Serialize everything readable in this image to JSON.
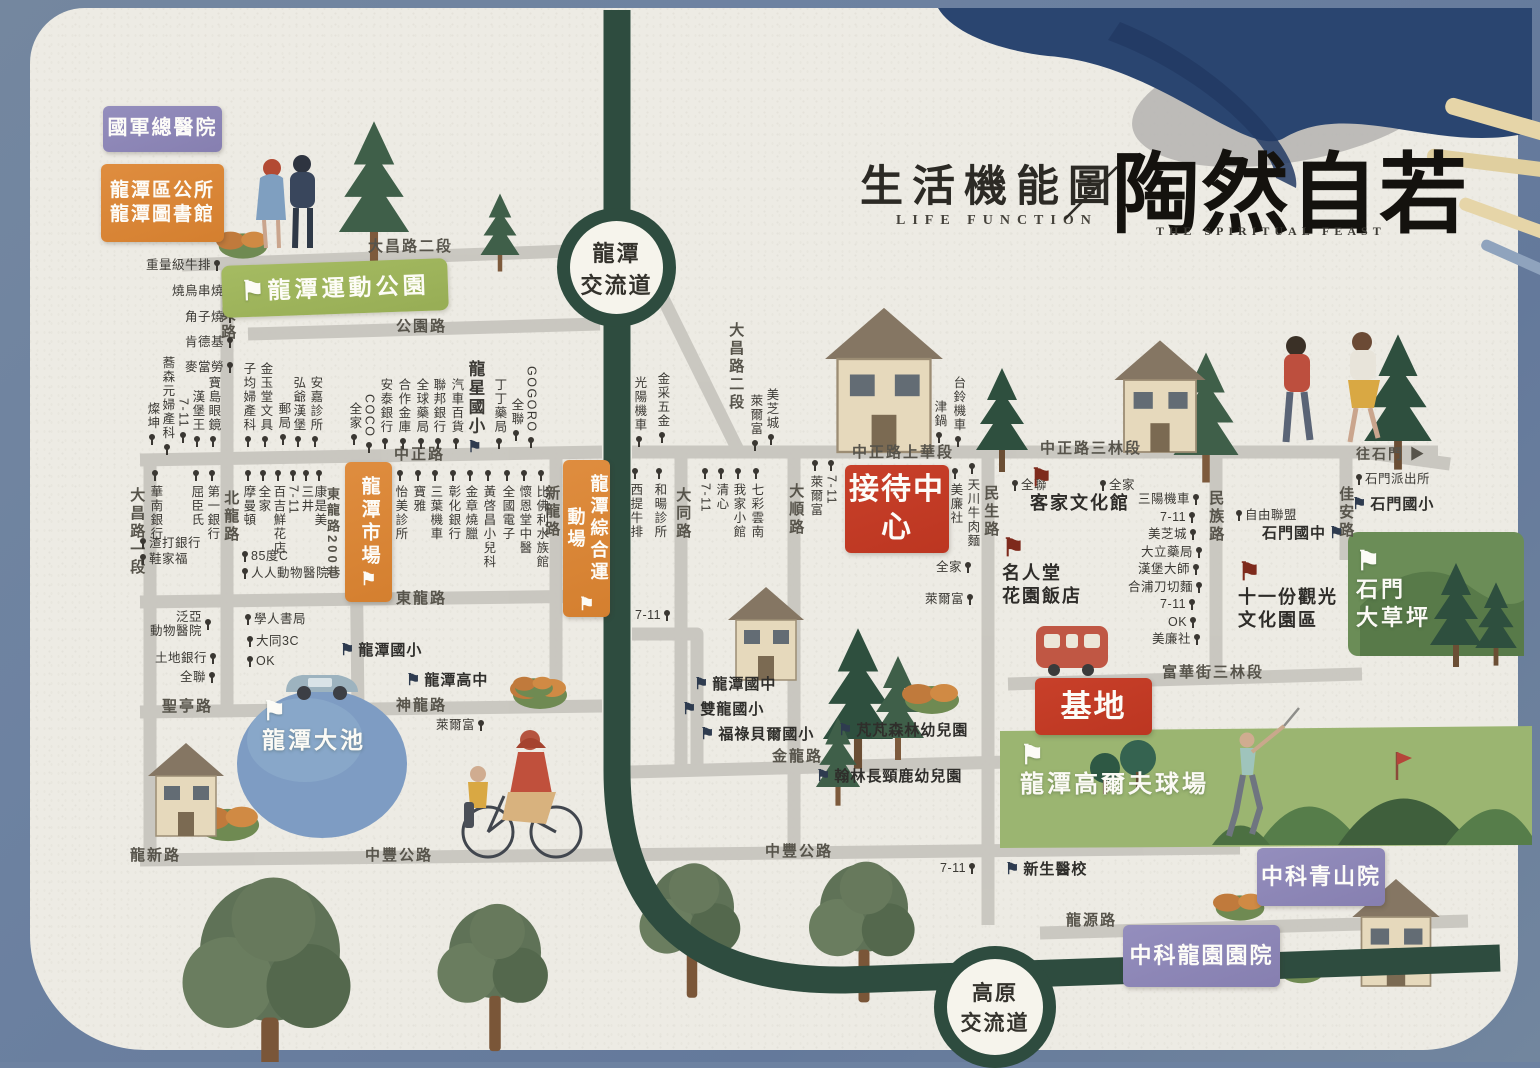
{
  "title": {
    "zh": "生活機能圖",
    "en": "LIFE FUNCTION",
    "slash": "／",
    "brand": "陶然自若",
    "brand_en": "THE SPIRITUAL FEAST"
  },
  "interchanges": [
    {
      "lines": [
        "龍潭",
        "交流道"
      ]
    },
    {
      "lines": [
        "高原",
        "交流道"
      ]
    }
  ],
  "palette": {
    "paper": "#edebe4",
    "border_blue": "#6d82a1",
    "freeway_green": "#2e4c3f",
    "road_gray": "#c7c4be",
    "box_red": "#c23c26",
    "box_orange": "#d9863a",
    "box_purple": "#8d87b7",
    "park_green": "#9fb65f",
    "pond_blue": "#7e9cc3",
    "golf_green": "#9bb571",
    "grass_green": "#6b8d57"
  },
  "map": {
    "items": [
      {
        "t": "大昌路二段",
        "c": "rh",
        "x": 368,
        "y": 238,
        "n": "road-label-dachang-rd-sec2"
      },
      {
        "t": "公園路",
        "c": "rh",
        "x": 396,
        "y": 318,
        "n": "road-label-gongyuan-rd"
      },
      {
        "t": "中興路",
        "c": "rv",
        "x": 219,
        "y": 288,
        "n": "road-label-zhongxing-rd"
      },
      {
        "t": "中正路",
        "c": "rh",
        "x": 394,
        "y": 446,
        "n": "road-label-zhongzheng-rd"
      },
      {
        "t": "北龍路",
        "c": "rv",
        "x": 222,
        "y": 490,
        "n": "road-label-beilong-rd"
      },
      {
        "t": "大昌路一段",
        "c": "rv",
        "x": 128,
        "y": 487,
        "n": "road-label-dachang-rd-sec1"
      },
      {
        "t": "東龍路",
        "c": "rh",
        "x": 396,
        "y": 590,
        "n": "road-label-donglong-rd"
      },
      {
        "t": "東龍路200巷",
        "c": "rv",
        "x": 324,
        "y": 487,
        "fs": 13,
        "n": "road-label-donglong-ln200"
      },
      {
        "t": "聖亭路",
        "c": "rh",
        "x": 162,
        "y": 698,
        "n": "road-label-shengting-rd"
      },
      {
        "t": "神龍路",
        "c": "rh",
        "x": 396,
        "y": 697,
        "n": "road-label-shenlong-rd"
      },
      {
        "t": "龍新路",
        "c": "rh",
        "x": 130,
        "y": 847,
        "n": "road-label-longxin-rd"
      },
      {
        "t": "中豐公路",
        "c": "rh",
        "x": 365,
        "y": 847,
        "n": "road-label-zhongfeng-hwy-w"
      },
      {
        "t": "中豐公路",
        "c": "rh",
        "x": 765,
        "y": 843,
        "n": "road-label-zhongfeng-hwy-e"
      },
      {
        "t": "大昌路二段",
        "c": "rv",
        "x": 727,
        "y": 322,
        "n": "road-label-dachang-rd-sec2-s"
      },
      {
        "t": "大同路",
        "c": "rv",
        "x": 674,
        "y": 487,
        "n": "road-label-datong-rd"
      },
      {
        "t": "大順路",
        "c": "rv",
        "x": 787,
        "y": 483,
        "n": "road-label-dashun-rd"
      },
      {
        "t": "新龍路",
        "c": "rv",
        "x": 543,
        "y": 485,
        "n": "road-label-xinlong-rd"
      },
      {
        "t": "民生路",
        "c": "rv",
        "x": 982,
        "y": 485,
        "n": "road-label-minsheng-rd"
      },
      {
        "t": "民族路",
        "c": "rv",
        "x": 1207,
        "y": 490,
        "n": "road-label-minzu-rd"
      },
      {
        "t": "佳安路",
        "c": "rv",
        "x": 1337,
        "y": 486,
        "n": "road-label-jiaan-rd"
      },
      {
        "t": "中正路上華段",
        "c": "rh",
        "x": 852,
        "y": 444,
        "n": "road-label-zhongzheng-shanghua"
      },
      {
        "t": "中正路三林段",
        "c": "rh",
        "x": 1040,
        "y": 440,
        "n": "road-label-zhongzheng-sanlin"
      },
      {
        "t": "富華街三林段",
        "c": "rh",
        "x": 1162,
        "y": 664,
        "n": "road-label-fuhua-st"
      },
      {
        "t": "金龍路",
        "c": "rh",
        "x": 772,
        "y": 748,
        "n": "road-label-jinlong-rd"
      },
      {
        "t": "龍源路",
        "c": "rh",
        "x": 1066,
        "y": 912,
        "n": "road-label-longyuan-rd"
      },
      {
        "t": "往石門 ▶",
        "c": "rh",
        "x": 1356,
        "y": 446,
        "fs": 14,
        "n": "direction-shimen"
      },
      {
        "t": "重量級牛排",
        "c": "ph",
        "x": 146,
        "y": 258,
        "p": "a"
      },
      {
        "t": "燒鳥串燒",
        "c": "ph",
        "x": 172,
        "y": 284,
        "p": "a"
      },
      {
        "t": "角子燒",
        "c": "ph",
        "x": 185,
        "y": 310,
        "p": "a"
      },
      {
        "t": "肯德基",
        "c": "ph",
        "x": 185,
        "y": 335,
        "p": "a"
      },
      {
        "t": "麥當勞",
        "c": "ph",
        "x": 185,
        "y": 360,
        "p": "a"
      },
      {
        "t": "蕎森元婦產科",
        "c": "pv",
        "x": 160,
        "y": 356,
        "p": "a"
      },
      {
        "t": "燦坤",
        "c": "pv",
        "x": 145,
        "y": 402,
        "p": "a"
      },
      {
        "t": "7-11",
        "c": "pv",
        "x": 176,
        "y": 398,
        "p": "a"
      },
      {
        "t": "漢堡王",
        "c": "pv",
        "x": 190,
        "y": 390,
        "p": "a"
      },
      {
        "t": "寶島眼鏡",
        "c": "pv",
        "x": 206,
        "y": 376,
        "p": "a"
      },
      {
        "t": "子均婦產科",
        "c": "pv",
        "x": 241,
        "y": 362,
        "p": "a"
      },
      {
        "t": "金玉堂文具",
        "c": "pv",
        "x": 258,
        "y": 362,
        "p": "a"
      },
      {
        "t": "郵局",
        "c": "pv",
        "x": 276,
        "y": 402,
        "p": "a"
      },
      {
        "t": "弘爺漢堡",
        "c": "pv",
        "x": 291,
        "y": 376,
        "p": "a"
      },
      {
        "t": "安嘉診所",
        "c": "pv",
        "x": 308,
        "y": 376,
        "p": "a"
      },
      {
        "t": "全家",
        "c": "pv",
        "x": 347,
        "y": 402,
        "p": "a"
      },
      {
        "t": "COCO",
        "c": "pv",
        "x": 362,
        "y": 394,
        "p": "a"
      },
      {
        "t": "安泰銀行",
        "c": "pv",
        "x": 378,
        "y": 378,
        "p": "a"
      },
      {
        "t": "合作金庫",
        "c": "pv",
        "x": 396,
        "y": 378,
        "p": "a"
      },
      {
        "t": "全球藥局",
        "c": "pv",
        "x": 414,
        "y": 378,
        "p": "a"
      },
      {
        "t": "聯邦銀行",
        "c": "pv",
        "x": 431,
        "y": 378,
        "p": "a"
      },
      {
        "t": "汽車百貨",
        "c": "pv",
        "x": 449,
        "y": 378,
        "p": "a"
      },
      {
        "t": "龍星國小",
        "c": "sv",
        "x": 465,
        "y": 360,
        "f": "dk",
        "fp": "a",
        "n": "school-longxing-elementary"
      },
      {
        "t": "丁丁藥局",
        "c": "pv",
        "x": 492,
        "y": 378,
        "p": "a"
      },
      {
        "t": "全聯",
        "c": "pv",
        "x": 509,
        "y": 398,
        "p": "a"
      },
      {
        "t": "GOGORO",
        "c": "pv",
        "x": 524,
        "y": 366,
        "p": "a"
      },
      {
        "t": "怡美診所",
        "c": "pv",
        "x": 393,
        "y": 470,
        "p": "b"
      },
      {
        "t": "寶雅",
        "c": "pv",
        "x": 411,
        "y": 470,
        "p": "b"
      },
      {
        "t": "三葉機車",
        "c": "pv",
        "x": 428,
        "y": 470,
        "p": "b"
      },
      {
        "t": "彰化銀行",
        "c": "pv",
        "x": 446,
        "y": 470,
        "p": "b"
      },
      {
        "t": "金章燒臘",
        "c": "pv",
        "x": 463,
        "y": 470,
        "p": "b"
      },
      {
        "t": "黃啓昌小兒科",
        "c": "pv",
        "x": 481,
        "y": 470,
        "p": "b"
      },
      {
        "t": "全國電子",
        "c": "pv",
        "x": 500,
        "y": 470,
        "p": "b"
      },
      {
        "t": "懷恩堂中醫",
        "c": "pv",
        "x": 517,
        "y": 470,
        "p": "b"
      },
      {
        "t": "比佛利水族館",
        "c": "pv",
        "x": 534,
        "y": 470,
        "p": "b"
      },
      {
        "t": "華南銀行",
        "c": "pv",
        "x": 148,
        "y": 470,
        "p": "b"
      },
      {
        "t": "屈臣氏",
        "c": "pv",
        "x": 189,
        "y": 470,
        "p": "b"
      },
      {
        "t": "第一銀行",
        "c": "pv",
        "x": 205,
        "y": 470,
        "p": "b"
      },
      {
        "t": "摩曼頓",
        "c": "pv",
        "x": 241,
        "y": 470,
        "p": "b"
      },
      {
        "t": "全家",
        "c": "pv",
        "x": 256,
        "y": 470,
        "p": "b"
      },
      {
        "t": "百吉鮮花店",
        "c": "pv",
        "x": 271,
        "y": 470,
        "p": "b"
      },
      {
        "t": "7-11",
        "c": "pv",
        "x": 286,
        "y": 470,
        "p": "b"
      },
      {
        "t": "三井",
        "c": "pv",
        "x": 299,
        "y": 470,
        "p": "b"
      },
      {
        "t": "康是美",
        "c": "pv",
        "x": 312,
        "y": 470,
        "p": "b"
      },
      {
        "t": "渣打銀行",
        "c": "ph",
        "x": 140,
        "y": 536,
        "p": "b"
      },
      {
        "t": "鞋家福",
        "c": "ph",
        "x": 140,
        "y": 552,
        "p": "b"
      },
      {
        "t": "85度C",
        "c": "ph",
        "x": 242,
        "y": 549,
        "p": "b"
      },
      {
        "t": "人人動物醫院",
        "c": "ph",
        "x": 242,
        "y": 566,
        "p": "b"
      },
      {
        "t": [
          "泛亞",
          "動物醫院"
        ],
        "c": "ph",
        "x": 150,
        "y": 610,
        "p": "a"
      },
      {
        "t": "土地銀行",
        "c": "ph",
        "x": 155,
        "y": 651,
        "p": "a"
      },
      {
        "t": "全聯",
        "c": "ph",
        "x": 180,
        "y": 670,
        "p": "a"
      },
      {
        "t": "學人書局",
        "c": "ph",
        "x": 245,
        "y": 612,
        "p": "b"
      },
      {
        "t": "大同3C",
        "c": "ph",
        "x": 247,
        "y": 634,
        "p": "b"
      },
      {
        "t": "OK",
        "c": "ph",
        "x": 247,
        "y": 654,
        "p": "b"
      },
      {
        "t": "龍潭國小",
        "c": "sh",
        "x": 340,
        "y": 642,
        "f": "dk",
        "fp": "b",
        "n": "school-longtan-elementary"
      },
      {
        "t": "龍潭高中",
        "c": "sh",
        "x": 406,
        "y": 672,
        "f": "dk",
        "fp": "b",
        "n": "school-longtan-high"
      },
      {
        "t": "萊爾富",
        "c": "ph",
        "x": 436,
        "y": 718,
        "p": "a"
      },
      {
        "t": "光陽機車",
        "c": "pv",
        "x": 632,
        "y": 376,
        "p": "a"
      },
      {
        "t": "金采五金",
        "c": "pv",
        "x": 655,
        "y": 372,
        "p": "a"
      },
      {
        "t": "萊爾富",
        "c": "pv",
        "x": 748,
        "y": 394,
        "p": "a"
      },
      {
        "t": "美芝城",
        "c": "pv",
        "x": 764,
        "y": 388,
        "p": "a"
      },
      {
        "t": "津鍋",
        "c": "pv",
        "x": 932,
        "y": 400,
        "p": "a"
      },
      {
        "t": "台鈴機車",
        "c": "pv",
        "x": 951,
        "y": 376,
        "p": "a"
      },
      {
        "t": "西提牛排",
        "c": "pv",
        "x": 628,
        "y": 468,
        "p": "b"
      },
      {
        "t": "和暘診所",
        "c": "pv",
        "x": 652,
        "y": 468,
        "p": "b"
      },
      {
        "t": "7-11",
        "c": "pv",
        "x": 698,
        "y": 468,
        "p": "b"
      },
      {
        "t": "清心",
        "c": "pv",
        "x": 714,
        "y": 468,
        "p": "b"
      },
      {
        "t": "我家小館",
        "c": "pv",
        "x": 731,
        "y": 468,
        "p": "b"
      },
      {
        "t": "七彩雲南",
        "c": "pv",
        "x": 749,
        "y": 468,
        "p": "b"
      },
      {
        "t": "萊爾富",
        "c": "pv",
        "x": 808,
        "y": 460,
        "p": "b"
      },
      {
        "t": "7-11",
        "c": "pv",
        "x": 824,
        "y": 460,
        "p": "b"
      },
      {
        "t": "美廉社",
        "c": "pv",
        "x": 948,
        "y": 468,
        "p": "b"
      },
      {
        "t": "天川牛肉麵",
        "c": "pv",
        "x": 965,
        "y": 463,
        "p": "b"
      },
      {
        "t": "全聯",
        "c": "ph",
        "x": 1012,
        "y": 478,
        "p": "b"
      },
      {
        "t": "全家",
        "c": "ph",
        "x": 1100,
        "y": 478,
        "p": "b"
      },
      {
        "t": "三陽機車",
        "c": "ph",
        "x": 1138,
        "y": 492,
        "p": "a"
      },
      {
        "t": "7-11",
        "c": "ph",
        "x": 1160,
        "y": 510,
        "p": "a"
      },
      {
        "t": "美芝城",
        "c": "ph",
        "x": 1148,
        "y": 527,
        "p": "a"
      },
      {
        "t": "大立藥局",
        "c": "ph",
        "x": 1141,
        "y": 545,
        "p": "a"
      },
      {
        "t": "漢堡大師",
        "c": "ph",
        "x": 1138,
        "y": 562,
        "p": "a"
      },
      {
        "t": "合浦刀切麵",
        "c": "ph",
        "x": 1128,
        "y": 580,
        "p": "a"
      },
      {
        "t": "7-11",
        "c": "ph",
        "x": 1160,
        "y": 597,
        "p": "a"
      },
      {
        "t": "OK",
        "c": "ph",
        "x": 1168,
        "y": 615,
        "p": "a"
      },
      {
        "t": "美廉社",
        "c": "ph",
        "x": 1152,
        "y": 632,
        "p": "a"
      },
      {
        "t": "自由聯盟",
        "c": "ph",
        "x": 1236,
        "y": 508,
        "p": "b"
      },
      {
        "t": "石門國中",
        "c": "sh",
        "x": 1262,
        "y": 525,
        "f": "dk",
        "fp": "a",
        "n": "school-shimen-junior-high"
      },
      {
        "t": "石門派出所",
        "c": "ph",
        "x": 1356,
        "y": 472,
        "p": "b",
        "n": "poi-shimen-police"
      },
      {
        "t": "石門國小",
        "c": "sh",
        "x": 1352,
        "y": 496,
        "f": "dk",
        "fp": "b",
        "n": "school-shimen-elementary"
      },
      {
        "t": "全家",
        "c": "ph",
        "x": 936,
        "y": 560,
        "p": "a"
      },
      {
        "t": "萊爾富",
        "c": "ph",
        "x": 925,
        "y": 592,
        "p": "a"
      },
      {
        "t": "客家文化館",
        "c": "lm",
        "x": 1030,
        "y": 466,
        "f": "rd",
        "fp": "b",
        "n": "landmark-hakka-culture-hall"
      },
      {
        "t": [
          "名人堂",
          "花園飯店"
        ],
        "c": "lm",
        "x": 1002,
        "y": 536,
        "f": "rd",
        "fp": "b",
        "n": "landmark-fame-hall-garden-hotel"
      },
      {
        "t": [
          "十一份觀光",
          "文化園區"
        ],
        "c": "lm",
        "x": 1238,
        "y": 560,
        "f": "rd",
        "fp": "b",
        "n": "landmark-shiyifen-culture-park"
      },
      {
        "t": [
          "石門",
          "大草坪"
        ],
        "c": "wlm",
        "x": 1356,
        "y": 548,
        "f": "wh",
        "fp": "b",
        "n": "landmark-shimen-lawn"
      },
      {
        "t": "龍潭高爾夫球場",
        "c": "wlm",
        "x": 1020,
        "y": 742,
        "fs": 24,
        "f": "wh",
        "fp": "b",
        "n": "landmark-longtan-golf-course"
      },
      {
        "t": "龍潭大池",
        "c": "wlm",
        "x": 262,
        "y": 698,
        "fs": 23,
        "f": "wh",
        "fp": "b",
        "n": "landmark-longtan-lake"
      },
      {
        "t": "7-11",
        "c": "ph",
        "x": 635,
        "y": 608,
        "p": "a"
      },
      {
        "t": "龍潭國中",
        "c": "sh",
        "x": 694,
        "y": 676,
        "f": "dk",
        "fp": "b",
        "n": "school-longtan-junior-high"
      },
      {
        "t": "雙龍國小",
        "c": "sh",
        "x": 682,
        "y": 701,
        "f": "dk",
        "fp": "b",
        "n": "school-shuanglong-elementary"
      },
      {
        "t": "福祿貝爾國小",
        "c": "sh",
        "x": 700,
        "y": 726,
        "f": "dk",
        "fp": "b",
        "n": "school-froebel-elementary"
      },
      {
        "t": "芃芃森林幼兒園",
        "c": "sh",
        "x": 838,
        "y": 722,
        "f": "dk",
        "fp": "b",
        "n": "school-pengpeng-kindergarten"
      },
      {
        "t": "翰林長頸鹿幼兒園",
        "c": "sh",
        "x": 816,
        "y": 768,
        "f": "dk",
        "fp": "b",
        "n": "school-hanlin-kindergarten"
      },
      {
        "t": "新生醫校",
        "c": "sh",
        "x": 1005,
        "y": 861,
        "f": "dk",
        "fp": "b",
        "n": "school-xinsheng-medical"
      },
      {
        "t": "7-11",
        "c": "ph",
        "x": 940,
        "y": 861,
        "p": "a"
      },
      {
        "t": "國軍總醫院",
        "c": "bx bx-purple",
        "x": 103,
        "y": 106,
        "w": 119,
        "h": 46,
        "fs": 20,
        "n": "area-armed-forces-hospital"
      },
      {
        "t": [
          "龍潭區公所",
          "龍潭圖書館"
        ],
        "c": "bx bx-orange",
        "x": 101,
        "y": 164,
        "w": 123,
        "h": 78,
        "fs": 19,
        "n": "area-district-office-library"
      },
      {
        "t": "龍潭市場",
        "c": "bx bx-orange bxv",
        "x": 345,
        "y": 462,
        "w": 47,
        "h": 140,
        "fs": 19,
        "f": "whs",
        "fp": "a",
        "n": "area-longtan-market"
      },
      {
        "t": "龍潭綜合運動場",
        "c": "bx bx-orange bxv bx-wrap",
        "x": 563,
        "y": 460,
        "w": 47,
        "h": 157,
        "fs": 18,
        "f": "whs",
        "fp": "a",
        "n": "area-longtan-sports-ground"
      },
      {
        "t": "接待中心",
        "c": "bx bx-red bx-wrap",
        "x": 845,
        "y": 465,
        "w": 104,
        "h": 88,
        "fs": 30,
        "n": "area-reception-center"
      },
      {
        "t": "基地",
        "c": "bx bx-red",
        "x": 1035,
        "y": 678,
        "w": 117,
        "h": 57,
        "fs": 31,
        "n": "area-project-site"
      },
      {
        "t": "中科青山院",
        "c": "bx bx-purple",
        "x": 1257,
        "y": 848,
        "w": 128,
        "h": 58,
        "fs": 22,
        "n": "area-zhongke-qingshan"
      },
      {
        "t": "中科龍園園院",
        "c": "bx bx-purple",
        "x": 1123,
        "y": 925,
        "w": 157,
        "h": 62,
        "fs": 22,
        "n": "area-zhongke-longyuan"
      },
      {
        "t": "龍潭運動公園",
        "c": "band",
        "x": 222,
        "y": 262,
        "w": 226,
        "h": 52,
        "fs": 23,
        "r": -2,
        "f": "wh",
        "fp": "b",
        "n": "area-longtan-sports-park"
      }
    ]
  }
}
